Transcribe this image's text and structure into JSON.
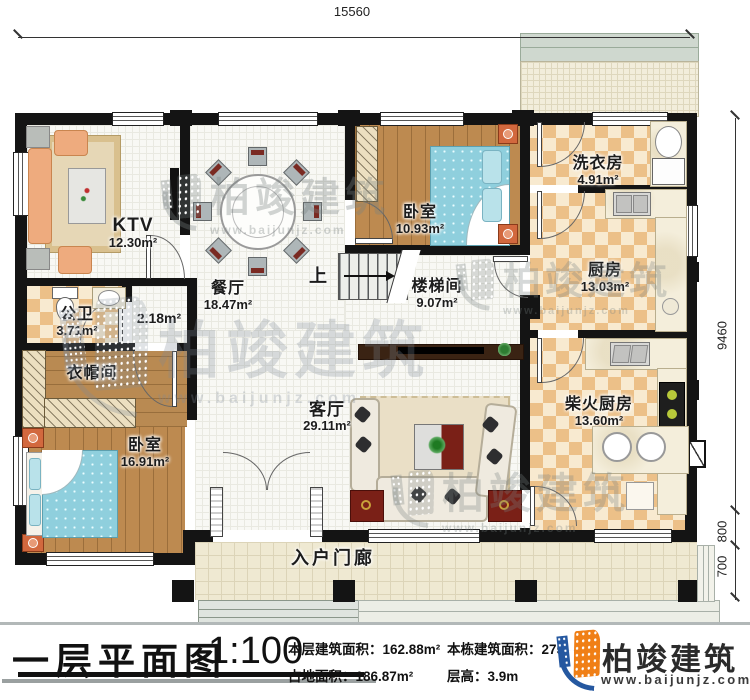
{
  "dimensions": {
    "top": "15560",
    "right_main": "9460",
    "right_mid": "800",
    "right_low": "700"
  },
  "rooms": {
    "ktv": {
      "name": "KTV",
      "area": "12.30m²"
    },
    "dining": {
      "name": "餐厅",
      "area": "18.47m²"
    },
    "bedroom_top": {
      "name": "卧室",
      "area": "10.93m²"
    },
    "laundry": {
      "name": "洗衣房",
      "area": "4.91m²"
    },
    "kitchen": {
      "name": "厨房",
      "area": "13.03m²"
    },
    "stairwell": {
      "name": "楼梯间",
      "area": "9.07m²"
    },
    "bathroom": {
      "name": "公卫",
      "area": "3.71m²"
    },
    "hallway": {
      "area": "2.18m²"
    },
    "cloakroom": {
      "name": "衣帽间"
    },
    "bedroom_bottom": {
      "name": "卧室",
      "area": "16.91m²"
    },
    "living": {
      "name": "客厅",
      "area": "29.11m²"
    },
    "firewood_kitchen": {
      "name": "柴火厨房",
      "area": "13.60m²"
    },
    "porch": {
      "name": "入户门廊"
    }
  },
  "stairs": {
    "up_label": "上"
  },
  "footer": {
    "title": "一层平面图",
    "scale": "1:100",
    "floor_area_label": "本层建筑面积：",
    "floor_area_value": "162.88m²",
    "land_area_label": "占地面积：",
    "land_area_value": "186.87m²",
    "total_area_label": "本栋建筑面积：",
    "total_area_value": "275",
    "story_height_label": "层高：",
    "story_height_value": "3.9m"
  },
  "brand": {
    "name": "柏竣建筑",
    "website": "www.baijunjz.com"
  },
  "watermark": {
    "name": "柏竣建筑",
    "website": "www.baijunjz.com"
  }
}
